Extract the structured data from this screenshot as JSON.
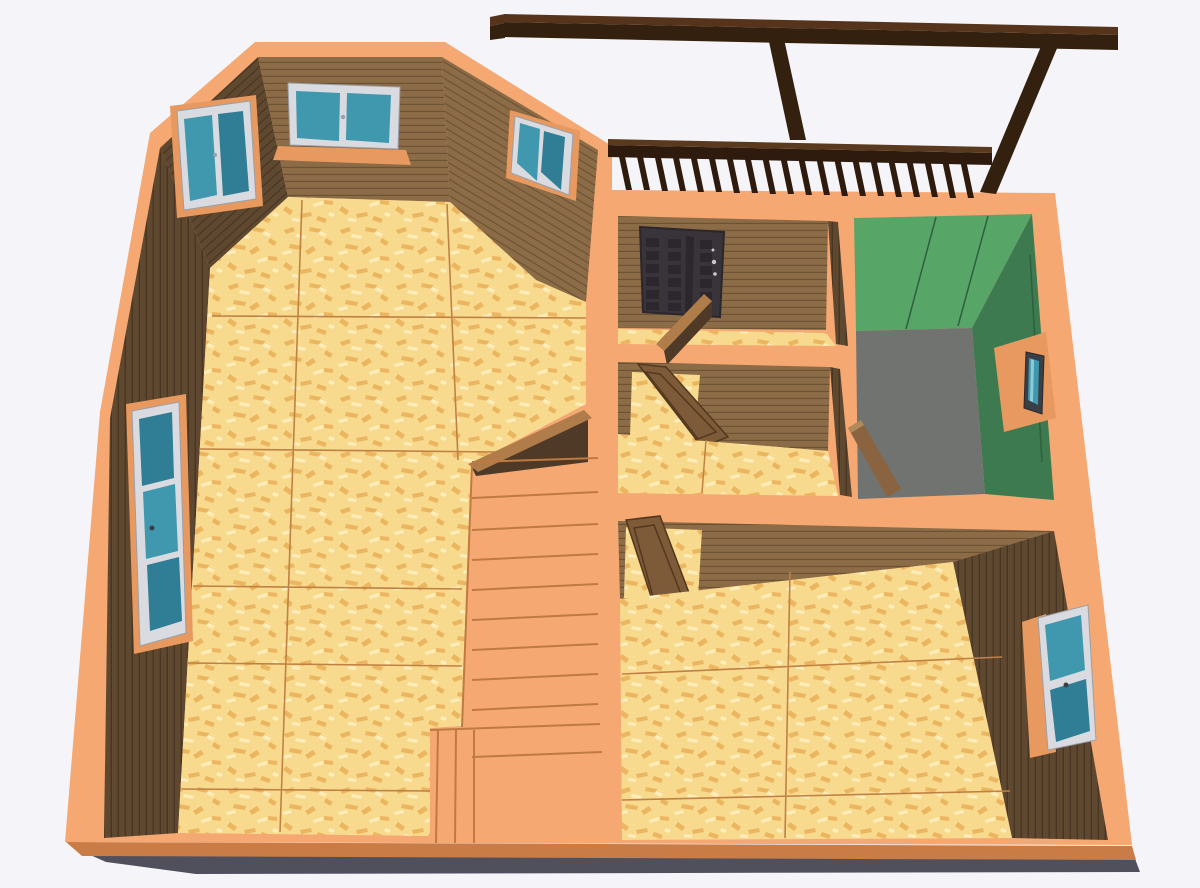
{
  "meta": {
    "type": "3d-floorplan-render",
    "description": "Top-down 3D cutaway render of a wooden house upper floor with pergola terrace, balcony railing, OSB floors and orange wall caps"
  },
  "colors": {
    "bg": "#f5f4f8",
    "orange": "#f6a873",
    "orange_deep": "#e8995f",
    "band_edge": "#c97c45",
    "shadow": "#50505c",
    "osb_base": "#f8da8e",
    "osb_fleck": "#e9b057",
    "osb_light": "#fdf0c0",
    "osb_seam": "#c08144",
    "wall_brown": "#8b6c47",
    "wall_line": "#6e5234",
    "wall_dark": "#5f4830",
    "dark_line": "#483522",
    "face_shadow": "#4e3a26",
    "stub_wood": "#b07c4a",
    "stair_line": "#bf7a42",
    "door_dark": "#39333a",
    "door_panel": "#2c272d",
    "door_glint": "#c9c9cf",
    "door_wood": "#7d5a38",
    "door_wood_edge": "#53381f",
    "door_wood_light": "#a87c4e",
    "glass": "#3f98ae",
    "glass_dark": "#2f7e95",
    "glass_light": "#8ecbd9",
    "frame_white": "#d9dbe0",
    "frame_gray": "#9aa0a8",
    "frame_dark": "#3a3f46",
    "green_light": "#57a667",
    "green_mid": "#3d7a50",
    "green_line": "#2e5f3f",
    "gray_floor": "#70736f",
    "plank": "#8a6340",
    "plank_light": "#b08a5a",
    "pergola_dark": "#33200f",
    "pergola_top": "#55341b",
    "rail_dark": "#2e1b0e",
    "rail_top": "#5a3a1e"
  },
  "scene": {
    "rooms": [
      {
        "name": "great-room",
        "floor": "osb",
        "windows": 4
      },
      {
        "name": "entry-hall",
        "floor": "osb",
        "doors": [
          "front-door"
        ]
      },
      {
        "name": "inner-hall",
        "floor": "osb",
        "doors": [
          "interior-door-open"
        ]
      },
      {
        "name": "green-room",
        "floor": "gray",
        "walls": "green",
        "windows": 1,
        "extras": [
          "leaning-plank"
        ]
      },
      {
        "name": "bedroom",
        "floor": "osb",
        "windows": 1,
        "doors": [
          "interior-door-open"
        ]
      }
    ],
    "stairs": {
      "treads": 9,
      "winders": 3
    },
    "railing": {
      "balusters": 20
    },
    "pergola": {
      "beams": 1,
      "rafters": 2
    }
  }
}
